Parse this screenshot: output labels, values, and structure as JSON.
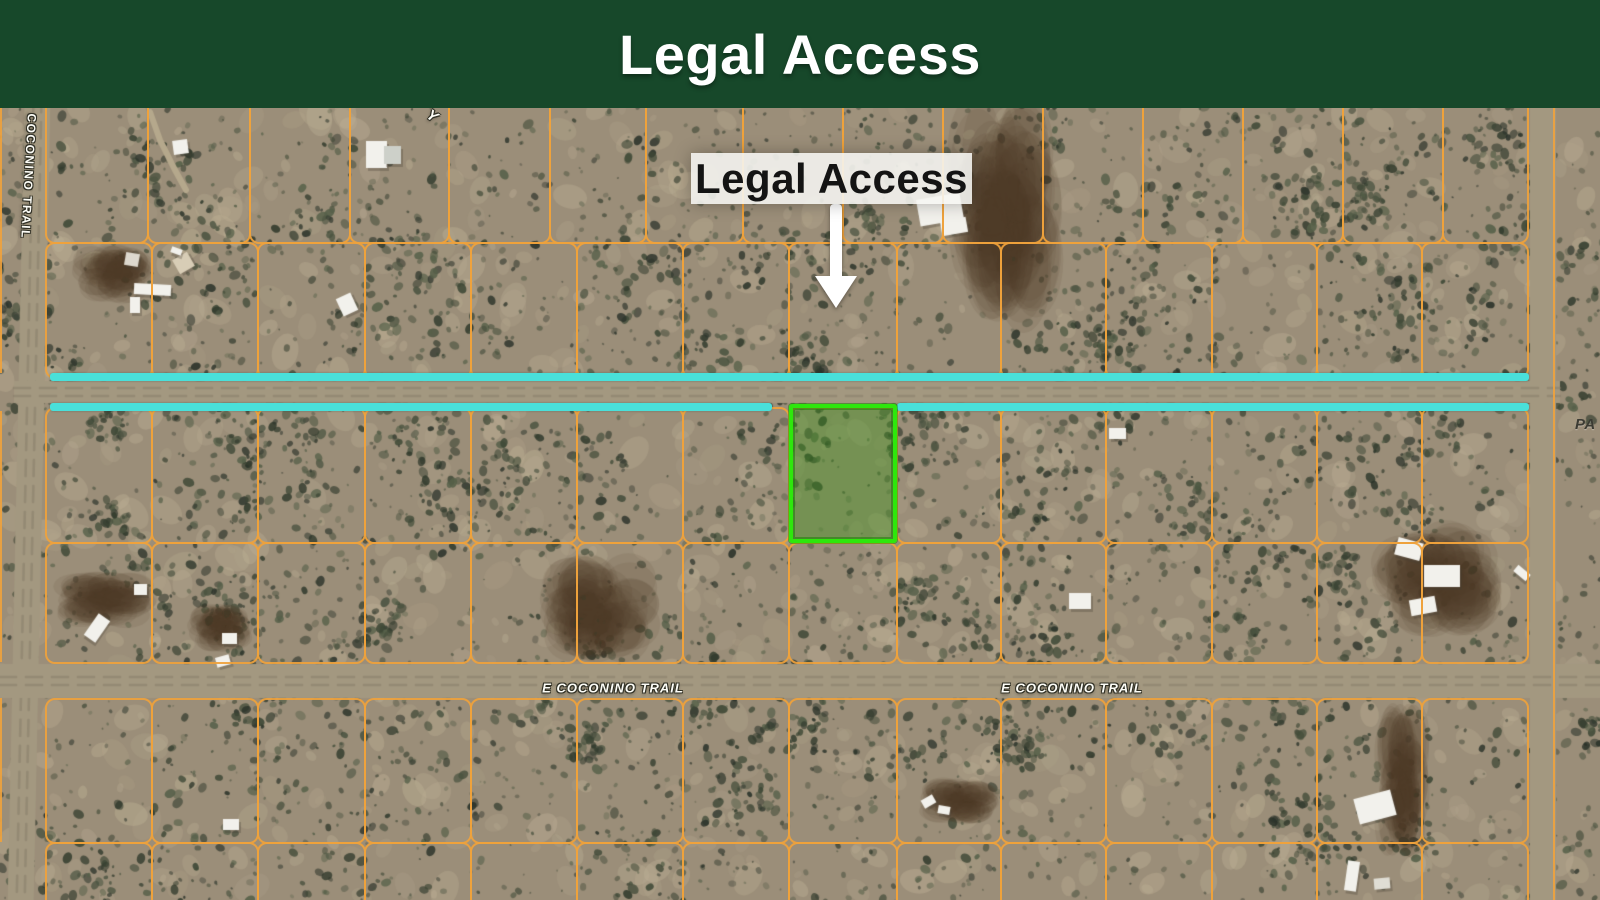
{
  "banner": {
    "title": "Legal Access",
    "bg_color": "#17482a"
  },
  "map": {
    "callout": {
      "label": "Legal Access",
      "box": {
        "x": 691,
        "y": 45,
        "w": 281,
        "h": 51
      },
      "arrow": {
        "x": 836,
        "shaft_top": 96,
        "shaft_h": 76,
        "shaft_w": 12,
        "head_top": 168
      }
    },
    "road_labels": {
      "vertical": {
        "text": "E COCONINO TRAIL",
        "x": 29,
        "y": 61,
        "rotation": 93
      },
      "horizontal": [
        {
          "text": "E COCONINO TRAIL",
          "x": 613,
          "y": 580
        },
        {
          "text": "E COCONINO TRAIL",
          "x": 1072,
          "y": 580
        }
      ],
      "partial_right": {
        "text": "PA",
        "x": 1575,
        "y": 308
      },
      "partial_top": {
        "text": "Y",
        "x": 427,
        "y": 0,
        "rotation": 35
      }
    },
    "colors": {
      "parcel_line": "#efa23c",
      "highlight": "#49e0da",
      "subject_border": "#2ee70c",
      "subject_fill": "rgba(72,148,38,0.45)"
    },
    "highlight": {
      "thickness": 8,
      "segments": [
        {
          "x": 50,
          "y": 265,
          "w": 1479
        },
        {
          "x": 50,
          "y": 295,
          "w": 722
        },
        {
          "x": 897,
          "y": 295,
          "w": 632
        }
      ]
    },
    "subject_parcel": {
      "x": 789,
      "y": 296,
      "w": 108,
      "h": 139
    },
    "grid": {
      "columns": {
        "top": [
          46,
          148,
          250,
          350,
          449,
          550,
          646,
          743,
          843,
          943,
          1043,
          1143,
          1243,
          1343,
          1443,
          1528
        ],
        "main": [
          46,
          152,
          258,
          365,
          471,
          577,
          683,
          789,
          897,
          1001,
          1106,
          1212,
          1317,
          1422,
          1528
        ]
      },
      "rows": [
        {
          "y0": -30,
          "y1": 134,
          "cols": "top"
        },
        {
          "y0": 134,
          "y1": 269,
          "cols": "main"
        },
        {
          "y0": 299,
          "y1": 434,
          "cols": "main"
        },
        {
          "y0": 434,
          "y1": 554,
          "cols": "main"
        },
        {
          "y0": 590,
          "y1": 734,
          "cols": "main"
        },
        {
          "y0": 734,
          "y1": 800,
          "cols": "main"
        }
      ],
      "left_edge_segments": [
        {
          "y0": 0,
          "y1": 265
        },
        {
          "y0": 303,
          "y1": 554
        },
        {
          "y0": 590,
          "y1": 734
        }
      ],
      "right_edge_line": {
        "x": 1553,
        "y0": 0,
        "y1": 792
      }
    },
    "roads": {
      "left_vertical": {
        "x": 16,
        "width": 26,
        "tilt_deg": 1.2
      },
      "access_horizontal": {
        "y0": 273,
        "y1": 295
      },
      "coconino_horizontal": {
        "y0": 556,
        "y1": 590
      },
      "right_vertical": {
        "x": 1530,
        "width": 26
      }
    },
    "structures": [
      {
        "x": 173,
        "y": 32,
        "w": 15,
        "h": 14,
        "rot": -8
      },
      {
        "x": 366,
        "y": 33,
        "w": 21,
        "h": 27,
        "rot": 0
      },
      {
        "x": 384,
        "y": 38,
        "w": 17,
        "h": 18,
        "rot": 0,
        "c": "#cdd0c9"
      },
      {
        "x": 918,
        "y": 88,
        "w": 44,
        "h": 27,
        "rot": -10
      },
      {
        "x": 941,
        "y": 111,
        "w": 26,
        "h": 15,
        "rot": -10
      },
      {
        "x": 125,
        "y": 145,
        "w": 14,
        "h": 13,
        "rot": 10,
        "c": "#ddd8ce"
      },
      {
        "x": 175,
        "y": 147,
        "w": 17,
        "h": 16,
        "rot": -30,
        "c": "#d8cdb6"
      },
      {
        "x": 171,
        "y": 140,
        "w": 11,
        "h": 6,
        "rot": 20
      },
      {
        "x": 134,
        "y": 176,
        "w": 37,
        "h": 11,
        "rot": 3
      },
      {
        "x": 130,
        "y": 189,
        "w": 10,
        "h": 16,
        "rot": 0
      },
      {
        "x": 339,
        "y": 187,
        "w": 16,
        "h": 19,
        "rot": -25
      },
      {
        "x": 1109,
        "y": 320,
        "w": 17,
        "h": 11,
        "rot": 0
      },
      {
        "x": 1069,
        "y": 485,
        "w": 22,
        "h": 16,
        "rot": 0
      },
      {
        "x": 1396,
        "y": 432,
        "w": 26,
        "h": 18,
        "rot": 15
      },
      {
        "x": 1424,
        "y": 457,
        "w": 36,
        "h": 22,
        "rot": 0
      },
      {
        "x": 1410,
        "y": 490,
        "w": 26,
        "h": 16,
        "rot": -10
      },
      {
        "x": 1514,
        "y": 461,
        "w": 16,
        "h": 8,
        "rot": 40
      },
      {
        "x": 90,
        "y": 507,
        "w": 14,
        "h": 26,
        "rot": 35
      },
      {
        "x": 134,
        "y": 476,
        "w": 13,
        "h": 11,
        "rot": 0
      },
      {
        "x": 222,
        "y": 525,
        "w": 15,
        "h": 11,
        "rot": 0
      },
      {
        "x": 216,
        "y": 548,
        "w": 14,
        "h": 10,
        "rot": -15
      },
      {
        "x": 223,
        "y": 711,
        "w": 16,
        "h": 11,
        "rot": 0
      },
      {
        "x": 1356,
        "y": 686,
        "w": 38,
        "h": 26,
        "rot": -15
      },
      {
        "x": 1346,
        "y": 753,
        "w": 12,
        "h": 30,
        "rot": 8
      },
      {
        "x": 1374,
        "y": 770,
        "w": 16,
        "h": 11,
        "rot": -5,
        "c": "#dfddd4"
      },
      {
        "x": 922,
        "y": 689,
        "w": 13,
        "h": 9,
        "rot": -30
      },
      {
        "x": 938,
        "y": 698,
        "w": 12,
        "h": 8,
        "rot": 10
      }
    ],
    "terrain": {
      "seed": 7,
      "base": "#9b8e79",
      "light": "#beb196",
      "shrub_colors": [
        "#3e4836",
        "#333c2e",
        "#2b332a",
        "#4a5340",
        "#566049"
      ],
      "road_color": "#a39880",
      "track_color": "#867b67",
      "dark_patch_color": "#4b382b",
      "trail_color": "#b5a88c",
      "dark_patches": [
        {
          "cx": 1005,
          "cy": 105,
          "rx": 55,
          "ry": 115
        },
        {
          "cx": 1437,
          "cy": 472,
          "rx": 60,
          "ry": 55
        },
        {
          "cx": 112,
          "cy": 166,
          "rx": 37,
          "ry": 27
        },
        {
          "cx": 105,
          "cy": 492,
          "rx": 48,
          "ry": 26
        },
        {
          "cx": 220,
          "cy": 520,
          "rx": 30,
          "ry": 22
        },
        {
          "cx": 960,
          "cy": 692,
          "rx": 38,
          "ry": 22
        },
        {
          "cx": 1402,
          "cy": 672,
          "rx": 26,
          "ry": 72
        },
        {
          "cx": 600,
          "cy": 500,
          "rx": 55,
          "ry": 50
        }
      ],
      "trail": [
        [
          150,
          4
        ],
        [
          160,
          32
        ],
        [
          175,
          62
        ],
        [
          186,
          82
        ]
      ]
    }
  }
}
